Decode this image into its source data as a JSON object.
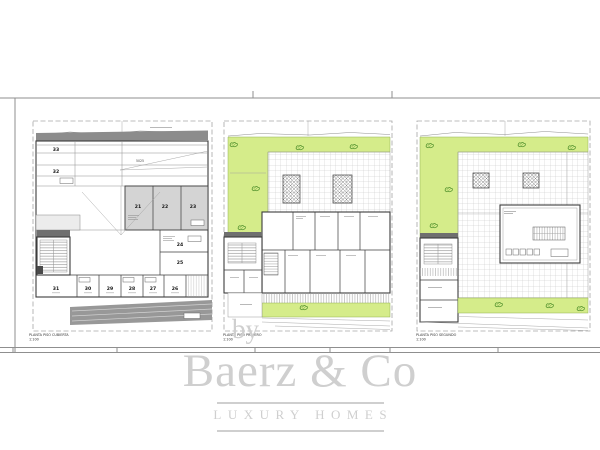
{
  "watermark": {
    "by": "by",
    "brand": "Baerz & Co",
    "tagline": "LUXURY HOMES"
  },
  "plans": [
    {
      "caption_line1": "PLANTA PISO CUBIERTA",
      "caption_scale": "1:100",
      "dim_label": "5025",
      "rooms": {
        "r21": "21",
        "r22": "22",
        "r23": "23",
        "r24": "24",
        "r25": "25",
        "r26": "26",
        "r27": "27",
        "r28": "28",
        "r29": "29",
        "r30": "30",
        "r31": "31",
        "r32": "32",
        "r33": "33"
      }
    },
    {
      "caption_line1": "PLANTA PISO PRIMERO",
      "caption_scale": "1:100"
    },
    {
      "caption_line1": "PLANTA PISO SEGUNDO",
      "caption_scale": "1:100"
    }
  ],
  "colors": {
    "lawn_green": "#d5ec8a",
    "plant_green": "#4e8f2a",
    "roof_gray": "#8c8c8c",
    "room_gray": "#d4d4d4",
    "ramp_gray": "#989898",
    "wall_line": "#3c3c3c",
    "watermark_gray": "#cfcfcf"
  }
}
